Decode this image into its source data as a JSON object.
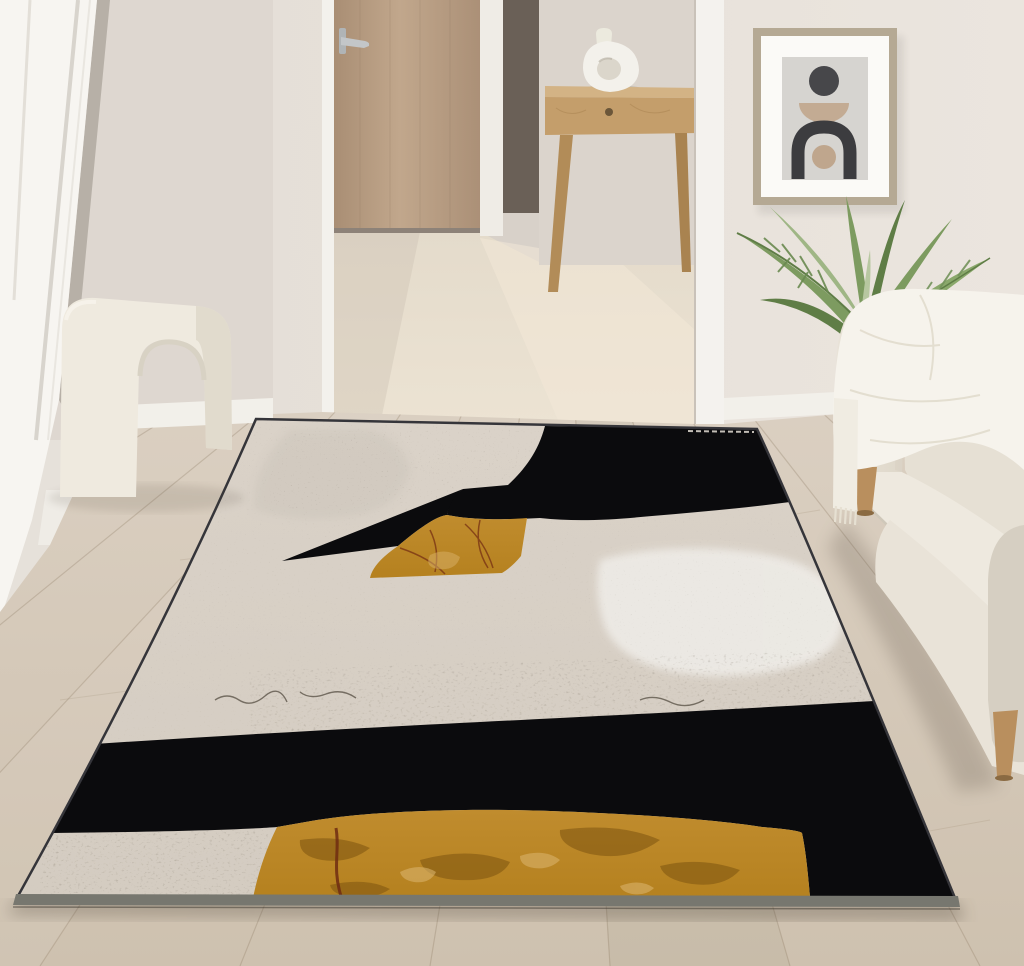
{
  "scene": {
    "type": "photograph",
    "setting": "minimalist living room staged with an abstract black, cream and gold area rug",
    "objects": [
      {
        "name": "french-door",
        "label": "white french door"
      },
      {
        "name": "hallway-door",
        "label": "light oak interior door with silver lever handle"
      },
      {
        "name": "console-table",
        "label": "wood console table with drawer"
      },
      {
        "name": "vase",
        "label": "white donut vase"
      },
      {
        "name": "framed-art",
        "label": "framed abstract print: circle, bowl, arch"
      },
      {
        "name": "palm-plant",
        "label": "areca palm in dark planter"
      },
      {
        "name": "sofa",
        "label": "cream daybed sofa with wooden legs"
      },
      {
        "name": "throw-blanket",
        "label": "white fringed throw"
      },
      {
        "name": "arch-stool",
        "label": "cream boucle arch stool"
      },
      {
        "name": "wood-floor",
        "label": "light oak plank floor"
      },
      {
        "name": "area-rug",
        "label": "abstract rug in cream, black and mustard gold"
      }
    ]
  },
  "colors": {
    "wall_left": "#ded7d0",
    "wall_main": "#e3ddd6",
    "wall_main_light": "#ebe5de",
    "wall_hall": "#d8d1c9",
    "trim_white": "#f4f2ee",
    "french_door_white": "#f7f5f1",
    "gap_shadow": "#b7b0a7",
    "door_wood": "#c1a78c",
    "door_wood_dark": "#a98e74",
    "handle_silver": "#c3c6c8",
    "dark_slot": "#6a6057",
    "hall_floor": "#ece3d3",
    "floor_top": "#dbd0c2",
    "floor_bottom": "#cec1af",
    "baseboard": "#f2f0ea",
    "console_wood": "#c49e6b",
    "console_leg": "#b28c58",
    "knob": "#6b5639",
    "vase_white": "#f3f1eb",
    "vase_hole": "#dbd6cb",
    "frame_metal": "#b5a994",
    "art_mat": "#fbfaf7",
    "art_bg": "#d6d4d0",
    "art_dark": "#47474a",
    "art_arch": "#3c3c3f",
    "art_tan": "#c3ab93",
    "art_tan2": "#bfa68d",
    "plant_green": "#7d9b60",
    "plant_green_dark": "#5f7d46",
    "plant_green_light": "#9fb685",
    "pot_dark": "#3c3a36",
    "sofa_cream": "#e9e3d8",
    "sofa_light": "#eee9df",
    "sofa_shade": "#d6cfc2",
    "throw_white": "#f6f3ec",
    "leg_wood": "#b98f5e",
    "stool_cream": "#efeadf",
    "stool_shade": "#dcd5c7",
    "rug_cream": "#dad2c8",
    "rug_cream_dark": "#cbc4ba",
    "rug_cloud": "#edeae5",
    "rug_black": "#0b0b0d",
    "rug_gold": "#b5811f",
    "rug_gold_dark": "#7d5410",
    "rug_gold_light": "#d9b26a",
    "rug_maroon": "#6f2c12",
    "rug_serge": "#77776f"
  }
}
